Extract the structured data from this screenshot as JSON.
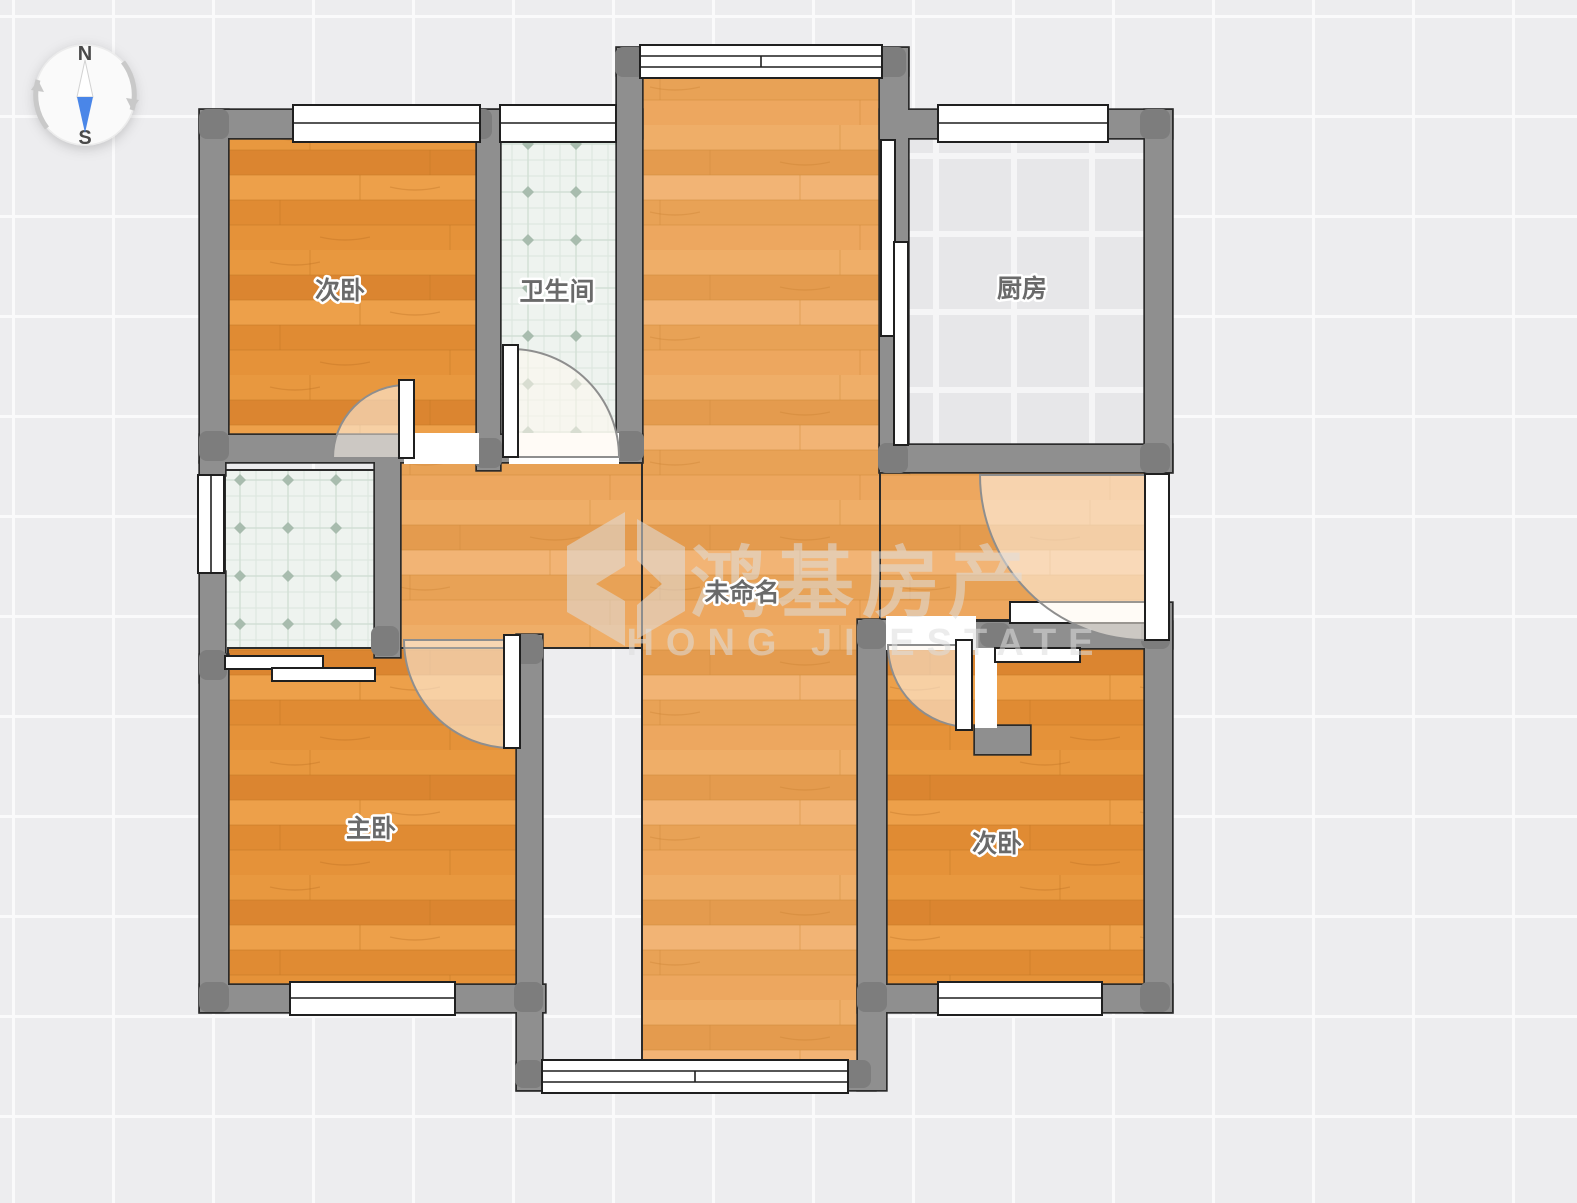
{
  "compass": {
    "north": "N",
    "south": "S",
    "needle_color": "#4a86e8"
  },
  "rooms": [
    {
      "key": "bedroom-top-left",
      "label": "次卧"
    },
    {
      "key": "bathroom",
      "label": "卫生间"
    },
    {
      "key": "kitchen",
      "label": "厨房"
    },
    {
      "key": "living-unnamed",
      "label": "未命名"
    },
    {
      "key": "master-bedroom",
      "label": "主卧"
    },
    {
      "key": "bedroom-bottom-right",
      "label": "次卧"
    }
  ],
  "watermark": {
    "brand_cn": "鸿基房产",
    "brand_en": "HONG JI ESTATE"
  },
  "colors": {
    "wall": "#8f8f8f",
    "wood": "#e18d35",
    "wood_light": "#eaa45c",
    "bath_tile": "#eef3ef",
    "kitchen_tile": "#e7e7e9",
    "label_text": "#6a6a6a",
    "needle_south": "#4a86e8"
  }
}
